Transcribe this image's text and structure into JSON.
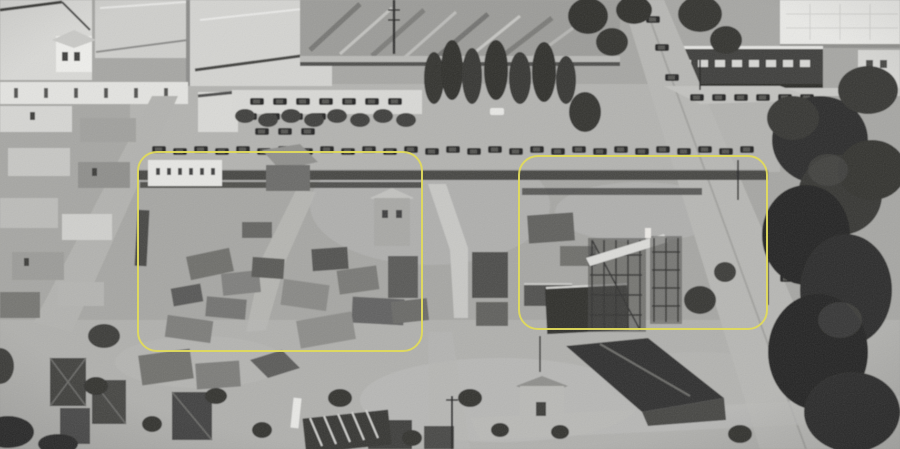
{
  "photo": {
    "kind": "black-and-white aerial photograph",
    "alt": "Aerial view of a movie studio backlot: sound stages and warehouses along the top, rows of parked vintage cars, a lumber yard, ramshackle outdoor film sets in the center, a tree-lined road on the right and scattered set flats and sheds below. Two set areas are outlined with yellow rounded rectangles.",
    "tones": {
      "highlight": "#eaeae7",
      "light": "#cfcfcc",
      "mid": "#a6a6a3",
      "dark": "#454543",
      "shadow": "#262624"
    }
  },
  "annotations": {
    "highlight_color": "#e0da5c",
    "boxes": [
      {
        "id": "highlight-box-left",
        "label": "left highlighted set area",
        "x": 137,
        "y": 151,
        "width": 286,
        "height": 201,
        "corner_radius": 20,
        "border_px": 2
      },
      {
        "id": "highlight-box-right",
        "label": "right highlighted set area",
        "x": 518,
        "y": 155,
        "width": 250,
        "height": 175,
        "corner_radius": 20,
        "border_px": 2
      }
    ]
  }
}
